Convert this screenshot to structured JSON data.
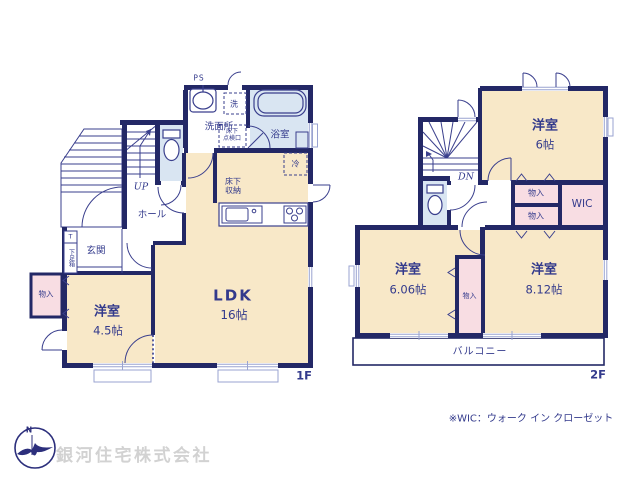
{
  "floor1": {
    "label": "1F",
    "ldk": "LDK",
    "ldk_size": "16帖",
    "bedroom": "洋室",
    "bedroom_size": "4.5帖",
    "hall": "ホール",
    "entrance": "玄関",
    "washroom": "洗面所",
    "bathroom": "浴室",
    "washer": "洗",
    "ps": "PS",
    "up": "UP",
    "fridge": "冷",
    "underfloor_hatch": "床下\n点検口",
    "underfloor_storage": "床下\n収納",
    "closet": "物入",
    "shoe_t": "T",
    "shoe_box": "下足箱"
  },
  "floor2": {
    "label": "2F",
    "dn": "DN",
    "bedroom6": "洋室",
    "bedroom6_size": "6帖",
    "bedroom606": "洋室",
    "bedroom606_size": "6.06帖",
    "bedroom812": "洋室",
    "bedroom812_size": "8.12帖",
    "closet_upper": "物入",
    "closet_lower": "物入",
    "closet_center": "物入",
    "wic": "WIC",
    "balcony": "バルコニー"
  },
  "footer": {
    "note": "※WIC：ウォーク イン クローゼット",
    "company": "銀河住宅株式会社",
    "logo_n": "N"
  },
  "colors": {
    "wall_navy": "#232866",
    "text_navy": "#333a8c",
    "room_cream": "#f8e8c8",
    "water_blue": "#d9e5f2",
    "closet_pink": "#f8dde3",
    "window_line": "#9aa3d0",
    "company_gray": "#d2d2d2"
  }
}
